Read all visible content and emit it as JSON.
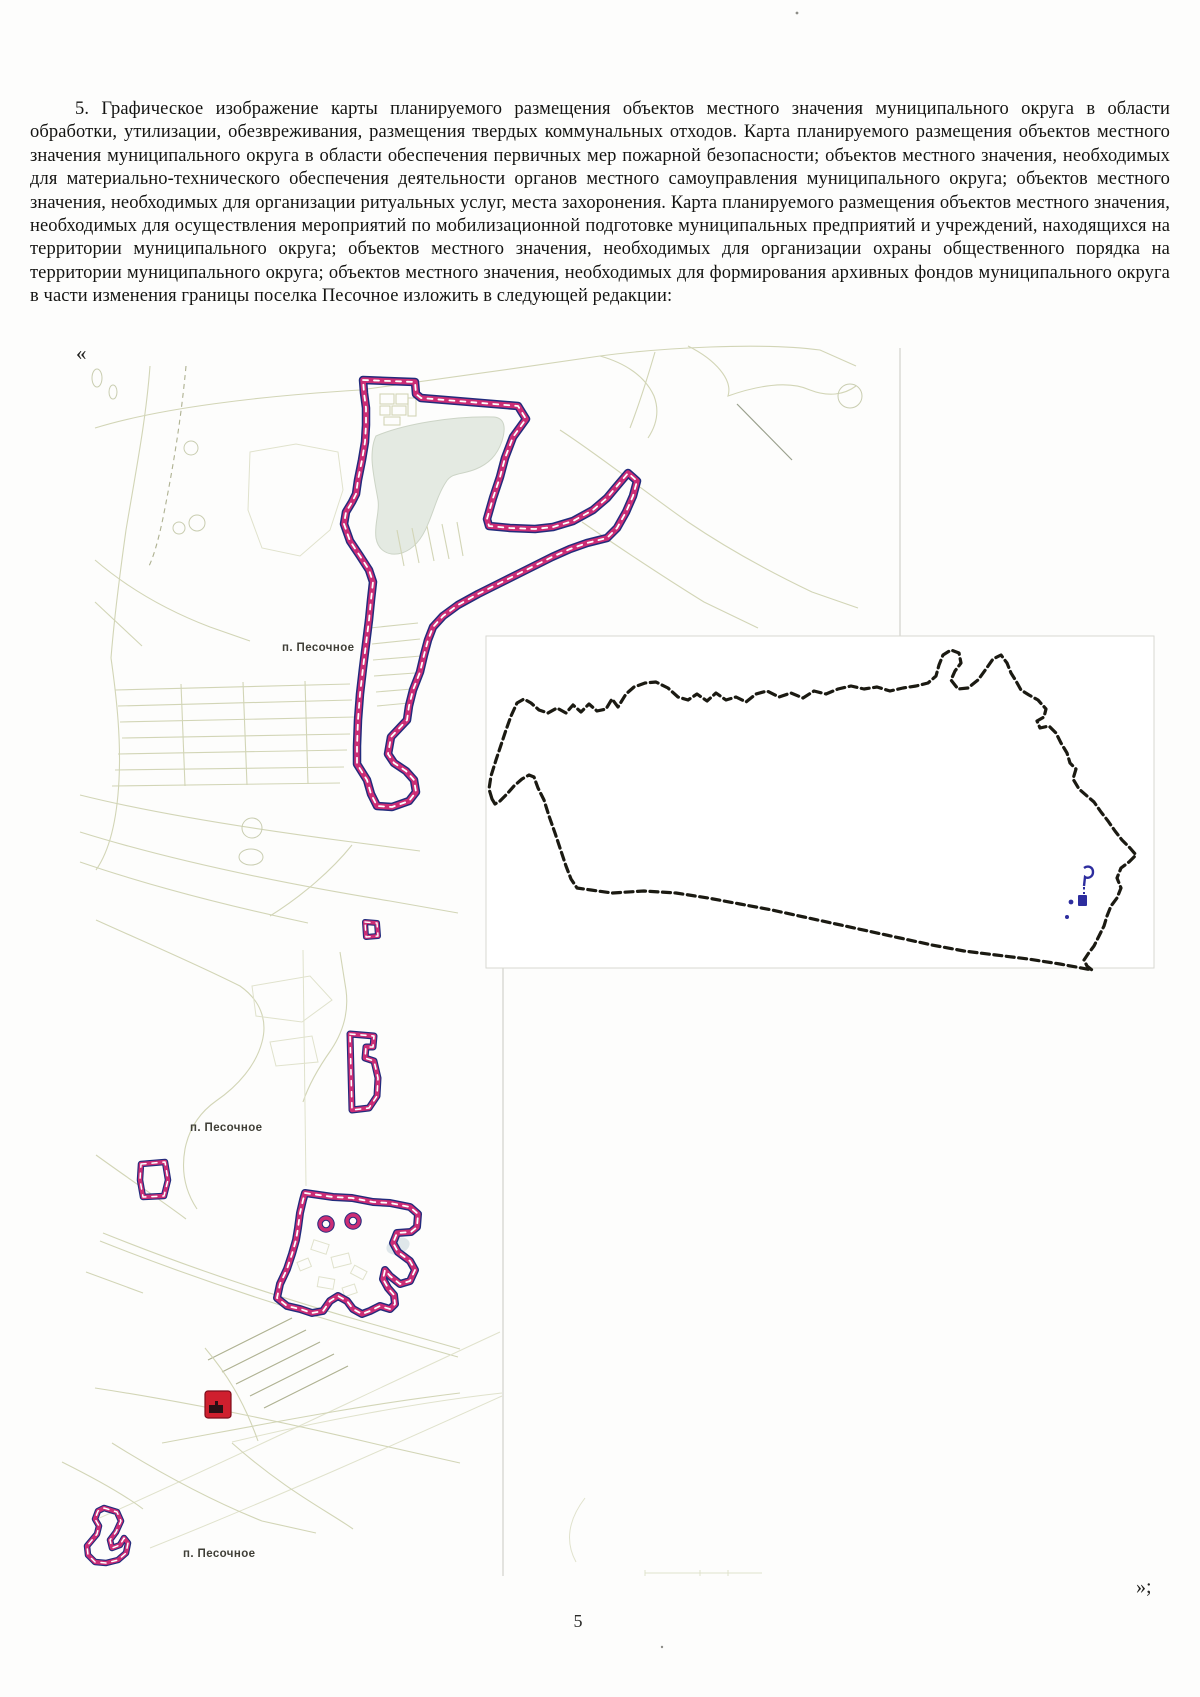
{
  "page": {
    "paragraph": "5. Графическое изображение карты планируемого размещения объектов местного значения муниципального округа в области обработки, утилизации, обезвреживания, размещения твердых коммунальных отходов. Карта планируемого размещения объектов местного значения муниципального округа в области обеспечения первичных мер пожарной безопасности; объектов местного значения, необходимых для материально-технического обеспечения деятельности органов местного самоуправления муниципального округа; объектов местного значения, необходимых для организации ритуальных услуг, места захоронения. Карта планируемого размещения объектов местного значения, необходимых для осуществления мероприятий по мобилизационной подготовке муниципальных предприятий и учреждений, находящихся на территории муниципального округа; объектов местного значения, необходимых для организации охраны общественного порядка на территории муниципального округа; объектов местного значения, необходимых для формирования архивных фондов муниципального округа в части изменения границы поселка Песочное изложить в следующей редакции:",
    "open_quote": "«",
    "close_quote": "»;",
    "page_number": "5"
  },
  "map": {
    "settlement_labels": [
      "п. Песочное",
      "п. Песочное",
      "п. Песочное"
    ],
    "colors": {
      "boundary_magenta": "#cc2d75",
      "boundary_navy": "#232b7c",
      "boundary_dash": "#ffffff",
      "district_black": "#1b1a12",
      "settlement_blue": "#2d2d9e",
      "object_red": "#cf1f2e",
      "road_olive": "#d2d5b6",
      "lake_green": "#e4eae2"
    }
  }
}
